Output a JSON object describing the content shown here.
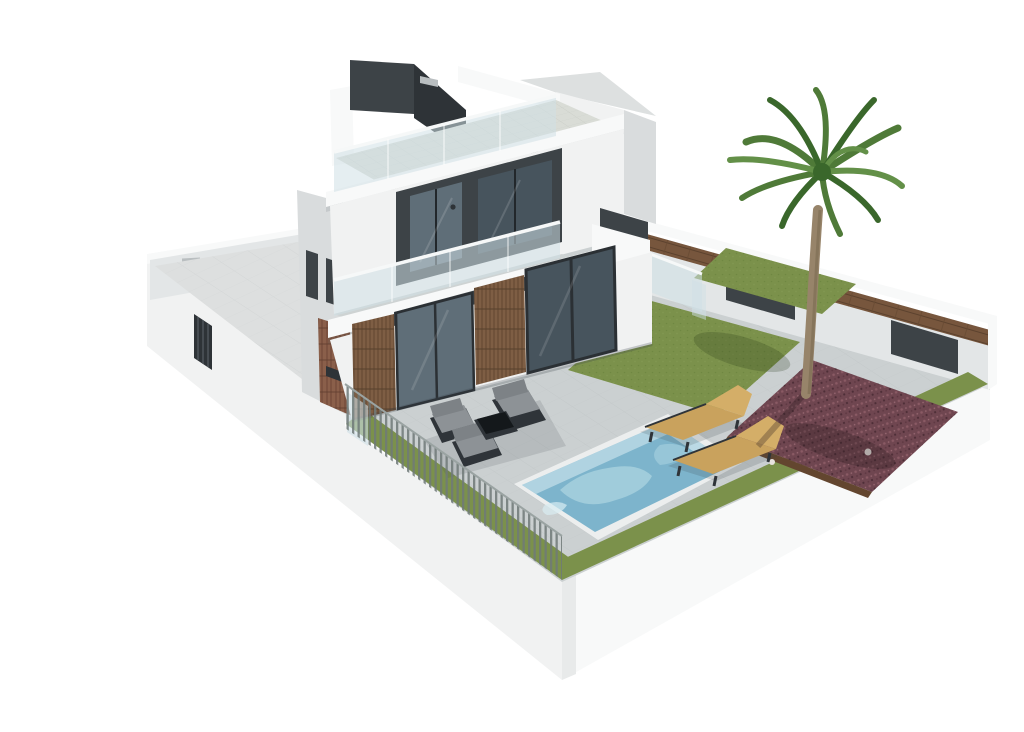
{
  "scene": {
    "title": "3D exterior rendering of a modern three-storey villa with rooftop terrace, garden and private pool",
    "view": "elevated three-quarter perspective on plain white background",
    "objects": [
      "villa-building",
      "rooftop-terrace",
      "stair-bulkhead",
      "balcony",
      "glass-balustrades",
      "wood-clad-entrance-columns",
      "sliding-glass-doors",
      "walled-courtyard",
      "courtyard-gate",
      "perimeter-wall",
      "wood-cladding-strip",
      "wall-panels",
      "slat-fence",
      "entrance-gate",
      "lawn",
      "back-lawn",
      "gravel-planting-bed",
      "palm-tree",
      "swimming-pool",
      "sun-lounger",
      "sun-lounger",
      "lounge-armchairs",
      "coffee-table",
      "paved-terrace",
      "plot-base"
    ]
  },
  "colors": {
    "background": "#ffffff",
    "wall_white": "#f1f2f2",
    "wall_bright": "#f8f9f9",
    "wall_shadow": "#e3e6e7",
    "wall_side": "#d9dcdd",
    "charcoal": "#3d4347",
    "charcoal_dark": "#2e3337",
    "window_glass": "#5f6e78",
    "window_glass_dark": "#47545d",
    "window_frame": "#2b3034",
    "balustrade_glass": "#cfe0e6",
    "rail_white": "#f6f8f8",
    "roof_tile": "#d9dcd6",
    "paving": "#cbd0d1",
    "paving_line": "#bfc4c5",
    "court_floor": "#dddfdf",
    "grass": "#7b914b",
    "grass_dark": "#66803a",
    "gravel": "#6f4650",
    "gravel_dark": "#52313a",
    "gravel_light": "#8a5a64",
    "wood": "#7e5e44",
    "wood_dark": "#63462f",
    "brick": "#8a5f4a",
    "lounger_wood": "#c9a25d",
    "furniture_frame": "#2f3439",
    "furniture_cushion": "#8d9296",
    "pool_water": "#7db4cc",
    "pool_light": "#a9d2df",
    "pool_wall": "#c2dde8",
    "palm_trunk": "#97846a",
    "palm_trunk_dark": "#7c6a51",
    "palm_green": "#4f7a38",
    "palm_green_dark": "#3a672b",
    "palm_green_light": "#639048",
    "fence_slat": "#6f7978",
    "vent_gray": "#b9bec0",
    "shadow": "rgba(55,65,70,0.20)"
  }
}
